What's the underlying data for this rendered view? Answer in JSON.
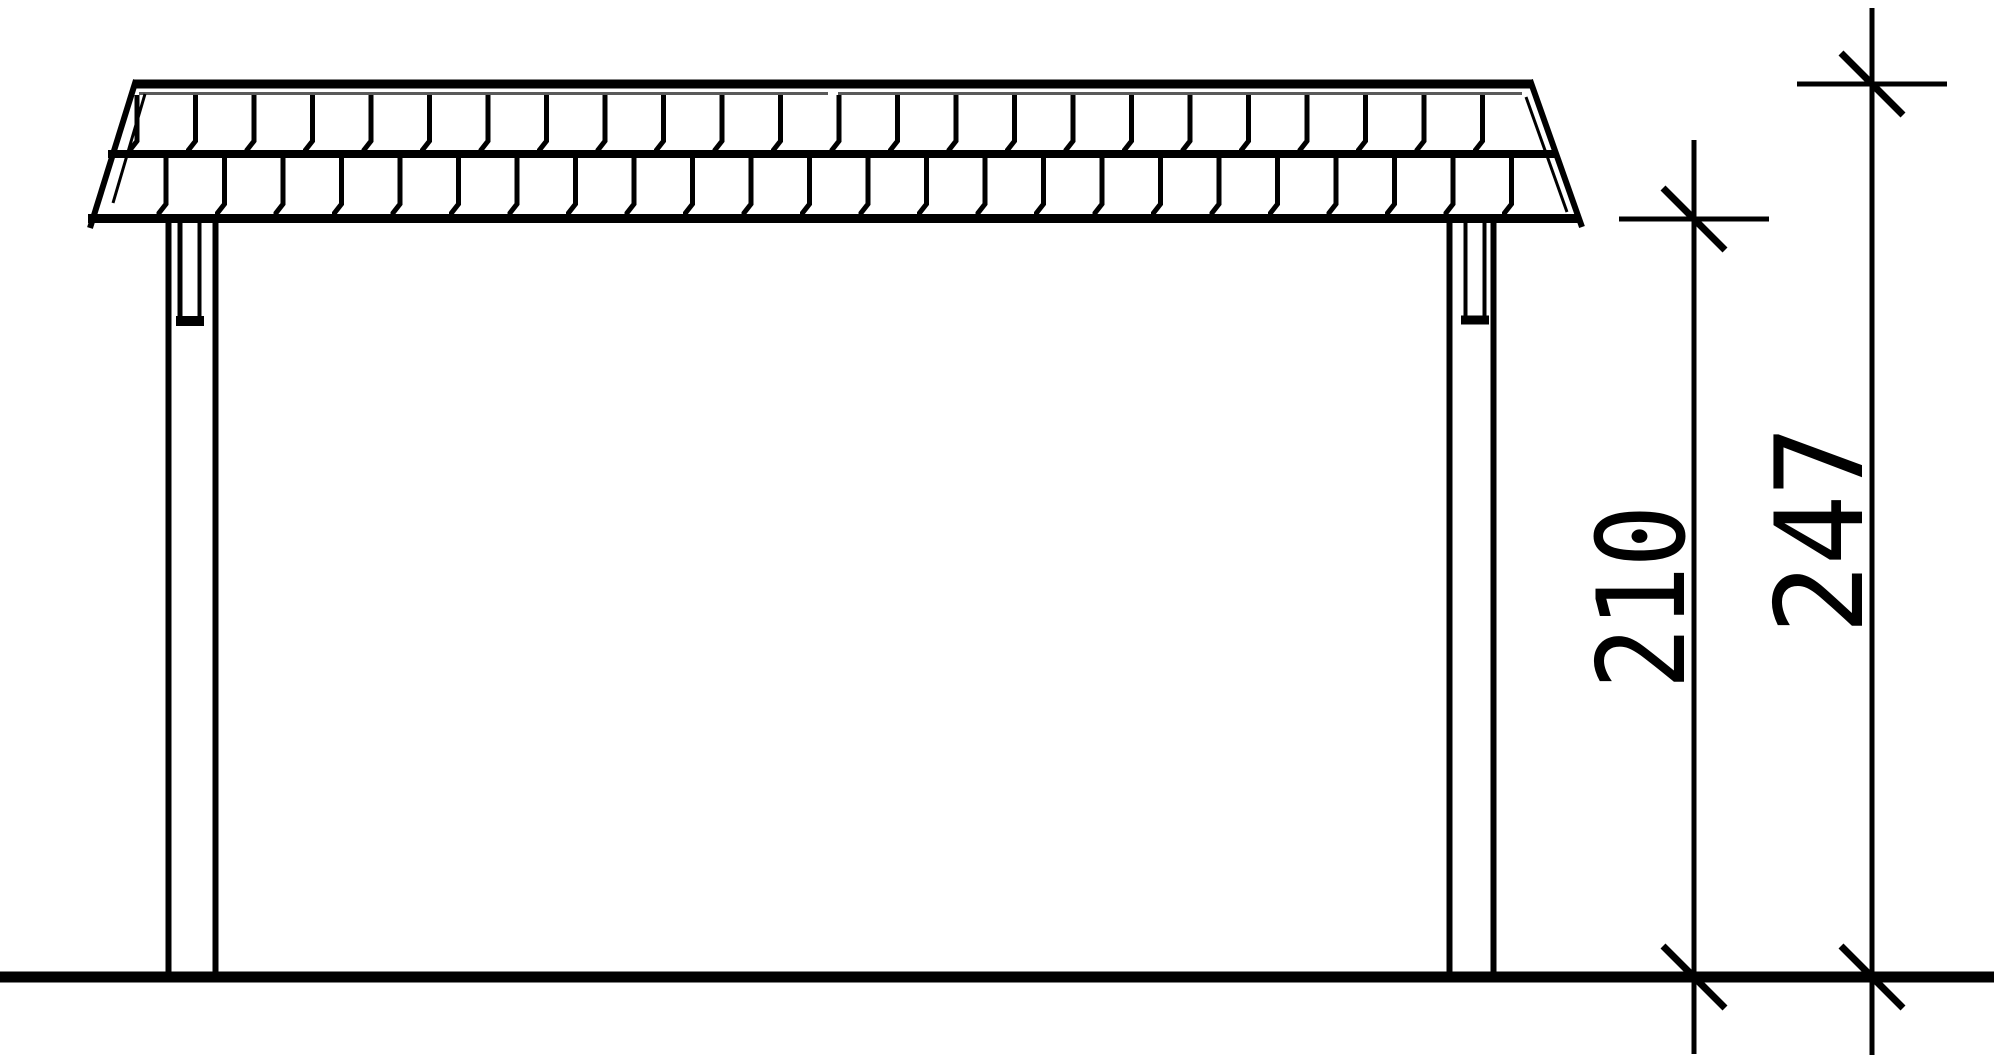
{
  "drawing": {
    "dimensions": {
      "height_to_eave": {
        "label": "210"
      },
      "height_to_roof_top": {
        "label": "247"
      }
    },
    "colors": {
      "line": "#000000",
      "thin_line": "#5a5a5a",
      "background": "#ffffff"
    }
  }
}
